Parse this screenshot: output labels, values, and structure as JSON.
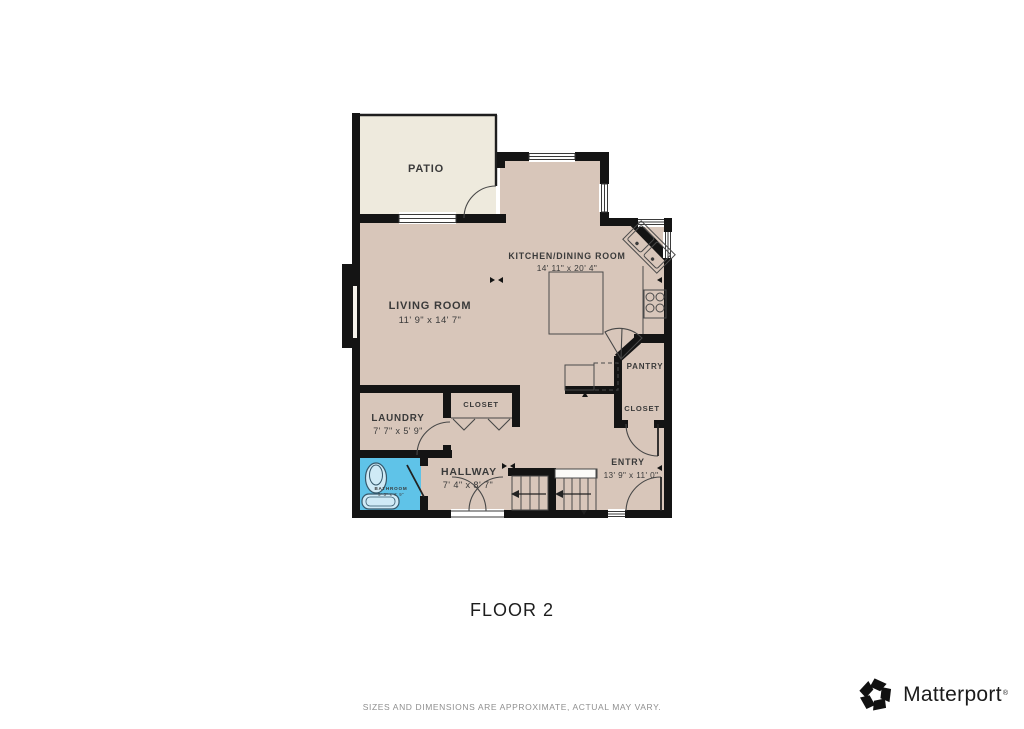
{
  "floor_label": "FLOOR 2",
  "disclaimer": "SIZES AND DIMENSIONS ARE APPROXIMATE, ACTUAL MAY VARY.",
  "brand": {
    "name": "Matterport",
    "registered": "®"
  },
  "colors": {
    "floor": "#d8c6ba",
    "patio_floor": "#eeeadd",
    "bathroom_floor": "#5fc3e8",
    "wall": "#141414"
  },
  "rooms": {
    "patio": {
      "name": "PATIO",
      "dims": ""
    },
    "living": {
      "name": "LIVING ROOM",
      "dims": "11' 9\" x 14' 7\""
    },
    "kitchen": {
      "name": "KITCHEN/DINING ROOM",
      "dims": "14' 11\" x 20' 4\""
    },
    "laundry": {
      "name": "LAUNDRY",
      "dims": "7' 7\" x 5' 9\""
    },
    "closet_hall": {
      "name": "CLOSET",
      "dims": ""
    },
    "hallway": {
      "name": "HALLWAY",
      "dims": "7' 4\" x 8' 7\""
    },
    "bathroom": {
      "name": "BATHROOM",
      "dims": "5' 3\" x 4' 9\""
    },
    "pantry": {
      "name": "PANTRY",
      "dims": ""
    },
    "closet_entry": {
      "name": "CLOSET",
      "dims": ""
    },
    "entry": {
      "name": "ENTRY",
      "dims": "13' 9\" x 11' 0\""
    }
  }
}
